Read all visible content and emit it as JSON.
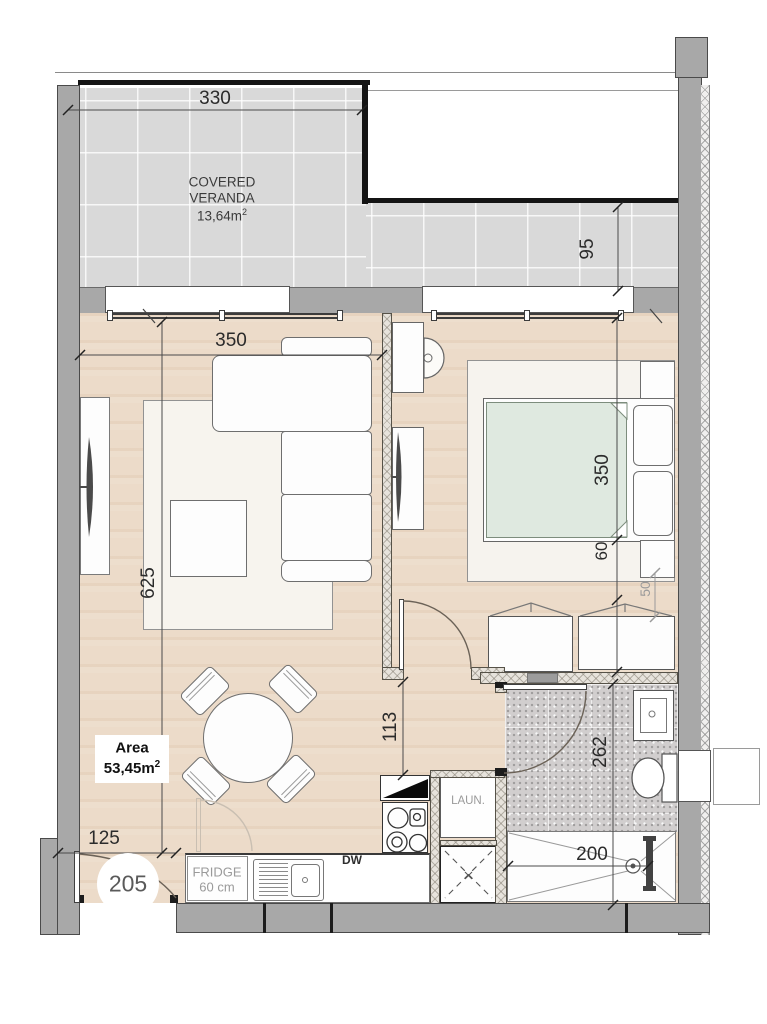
{
  "plan": {
    "unit_number": "205",
    "veranda": {
      "line1": "COVERED",
      "line2": "VERANDA",
      "area_value": "13,64m",
      "area_sup": "2"
    },
    "area_label": {
      "title": "Area",
      "value": "53,45m",
      "sup": "2"
    },
    "kitchen": {
      "fridge_line1": "FRIDGE",
      "fridge_line2": "60 cm",
      "dishwasher": "DW",
      "laundry": "LAUN."
    },
    "dimensions": {
      "veranda_width": "330",
      "veranda_depth": "95",
      "living_width": "350",
      "living_length": "625",
      "entry_width": "125",
      "corridor_length": "113",
      "bedroom_depth": "350",
      "wardrobe_depth": "60",
      "side_gap": "50",
      "bathroom_length": "262",
      "shower_width": "200"
    },
    "colors": {
      "exterior_wall": "#a8a8a8",
      "veranda_tile": "#d9d9d9",
      "wood_floor": "#ecdbc9",
      "bed_duvet": "#dfe9e0",
      "bath_tile": "#d1cece",
      "annotation": "#3a3a3a"
    }
  }
}
